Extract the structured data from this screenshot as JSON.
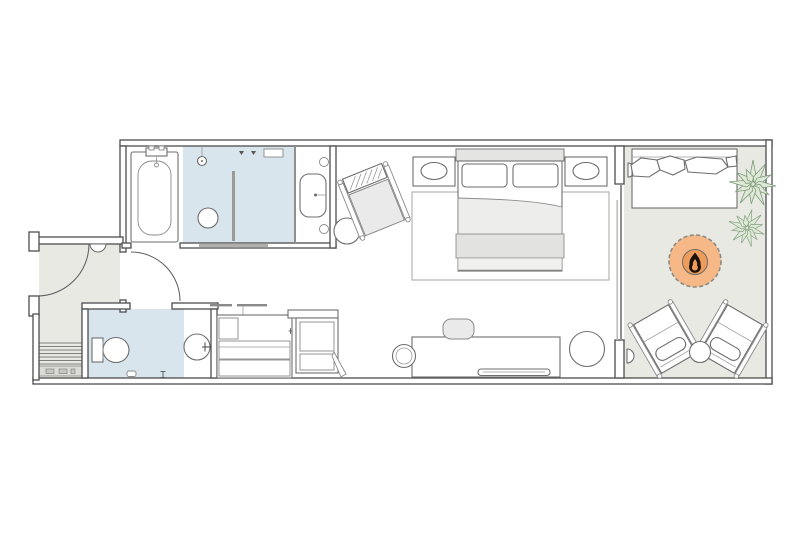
{
  "title": "hotel-suite-floor-plan",
  "colors": {
    "background": "#ffffff",
    "wall": "#4d4d4d",
    "floor_gray": "#e9e9e4",
    "wet_room_blue": "#d8e5ed",
    "stairs_band": "#dcdcd6",
    "glass": "#8f8f8f",
    "headboard": "#e4e4e2",
    "bedding": "#ededeb",
    "blanket": "#e2e2e0",
    "foot_throw": "#f0f0ee",
    "seat_cushion": "#eaeaea",
    "firepit_outer": "#f5b886",
    "firepit_inner": "#ee9c5c",
    "firepit_flame": "#1a110b",
    "plant_fill": "#dfe9d7",
    "plant_stroke": "#7d9c7a",
    "threshold": "#b0b0ac"
  },
  "rooms": [
    {
      "name": "bathroom",
      "items": [
        "bathtub",
        "tub-faucet",
        "walk-in-shower",
        "shower-head",
        "floor-drain",
        "glass-partition",
        "wall-niche",
        "vanity-sink",
        "vanity-lights"
      ]
    },
    {
      "name": "entry-hall",
      "items": [
        "entry-door",
        "door-swing",
        "wall-light",
        "steps",
        "landing-mat"
      ]
    },
    {
      "name": "powder-room",
      "items": [
        "toilet",
        "round-basin",
        "basin-faucet",
        "paper-holder"
      ]
    },
    {
      "name": "closet-nook",
      "items": [
        "hanging-rail",
        "minibar-cabinet",
        "drawers",
        "wardrobe-unit",
        "folding-rack"
      ]
    },
    {
      "name": "bedroom",
      "items": [
        "king-bed",
        "headboard",
        "pillows",
        "duvet",
        "folded-blanket",
        "nightstand-left",
        "nightstand-right",
        "table-lamp-left",
        "table-lamp-right",
        "area-rug",
        "armchair",
        "side-table",
        "desk",
        "desk-chair",
        "serving-tray",
        "round-stool",
        "ottoman",
        "bathroom-door"
      ]
    },
    {
      "name": "terrace",
      "items": [
        "sliding-glass-door",
        "daybed-sofa",
        "throw-pillows",
        "potted-plants",
        "fire-pit",
        "lounge-chair-left",
        "lounge-chair-right",
        "drink-table",
        "wall-light-upper",
        "wall-light-lower"
      ]
    }
  ]
}
